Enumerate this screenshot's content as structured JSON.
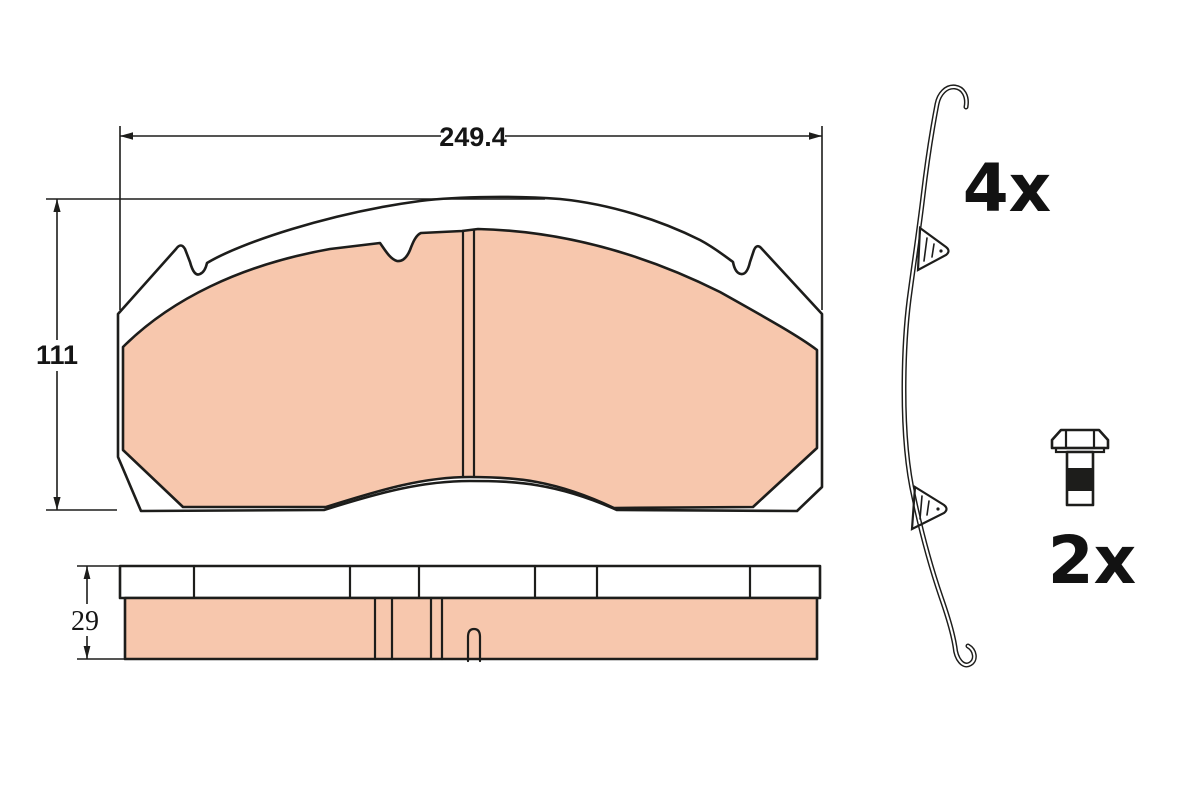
{
  "front_view": {
    "width_label": "249.4",
    "height_label": "111"
  },
  "side_view": {
    "thickness_label": "29"
  },
  "accessories": {
    "spring_clip": {
      "quantity_label": "4x"
    },
    "bolt": {
      "quantity_label": "2x"
    }
  },
  "colors": {
    "friction": "#f7c7ad",
    "backplate": "#ffffff",
    "line": "#1d1d1b",
    "thread_fill": "#1d1d1b"
  }
}
